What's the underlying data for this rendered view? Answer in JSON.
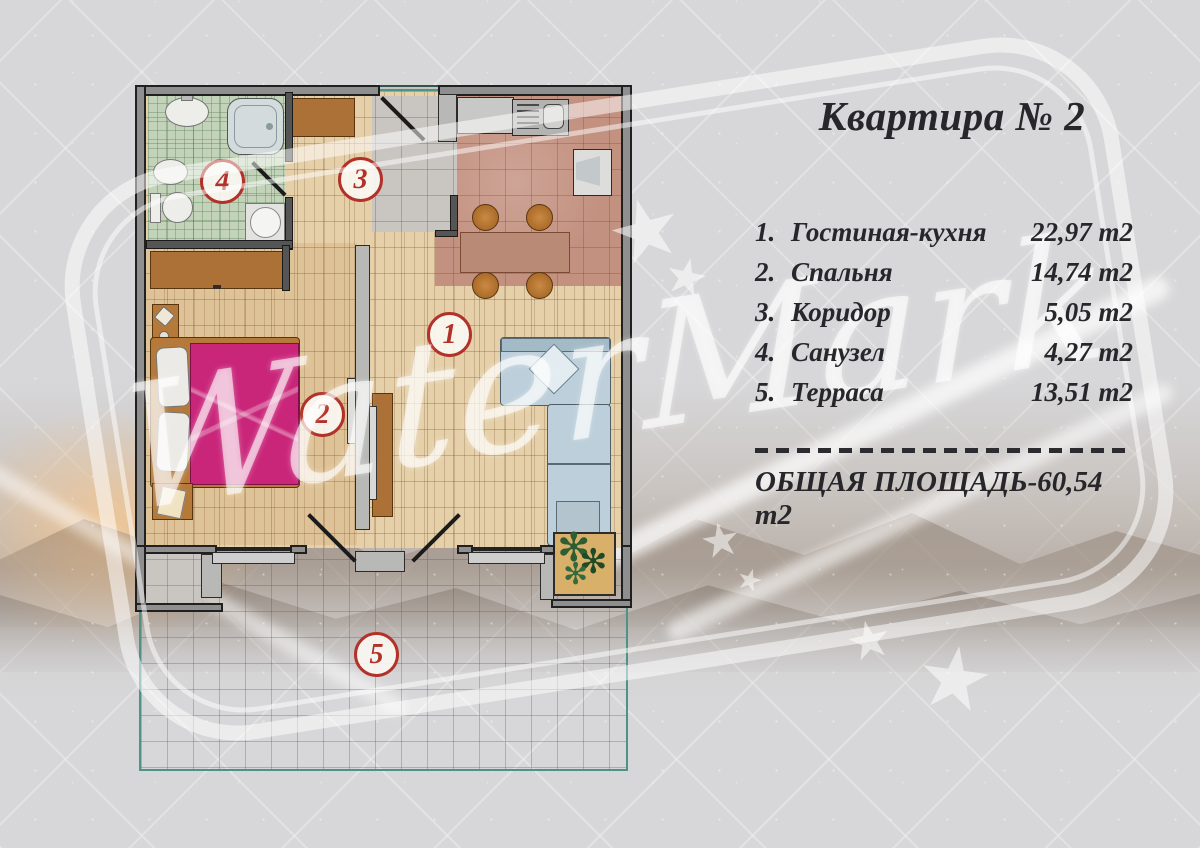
{
  "header": {
    "title": "Квартира № 2"
  },
  "legend": {
    "items": [
      {
        "num": "1.",
        "name": "Гостиная-кухня",
        "area": "22,97 m2"
      },
      {
        "num": "2.",
        "name": "Спальня",
        "area": "14,74 m2"
      },
      {
        "num": "3.",
        "name": "Коридор",
        "area": "5,05 m2"
      },
      {
        "num": "4.",
        "name": "Санузел",
        "area": "4,27 m2"
      },
      {
        "num": "5.",
        "name": "Терраса",
        "area": "13,51 m2"
      }
    ],
    "total_label": "ОБЩАЯ ПЛОЩАДЬ-60,54 m2"
  },
  "watermark": {
    "text": "WaterMark",
    "star_glyph": "★"
  },
  "plan": {
    "badges": {
      "living": "1",
      "bedroom": "2",
      "corridor": "3",
      "bathroom": "4",
      "terrace": "5"
    }
  },
  "colors": {
    "badge_red": "#b23129",
    "text_dark": "#26262b",
    "bed_pink": "#c9267a",
    "sofa_blue": "#bccfda",
    "bath_green": "#c3d3ba",
    "wood": "#e5d0aa",
    "kitchen_floor": "#c39180",
    "terrace_teal": "#4f9287",
    "wall_gray": "#8f8f8f"
  }
}
